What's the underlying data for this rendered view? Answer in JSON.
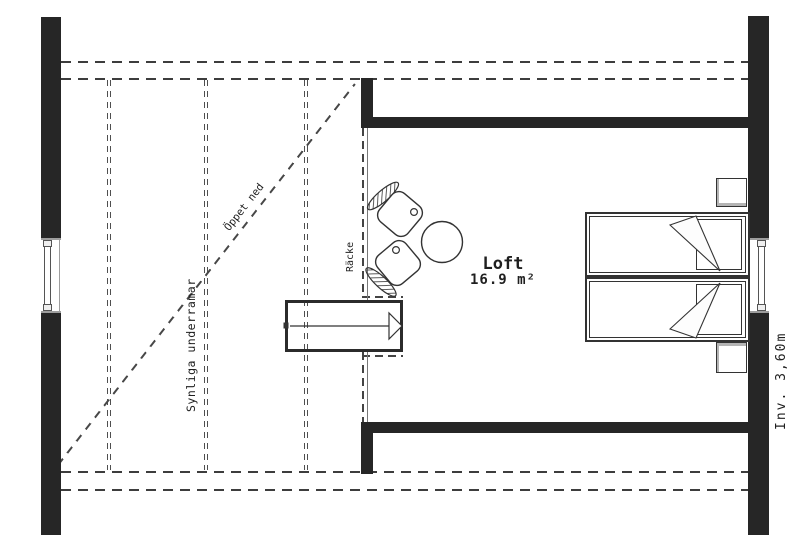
{
  "room": {
    "name": "Loft",
    "area": "16.9 m²"
  },
  "annotations": {
    "open_below": "Öppet ned",
    "visible_underframes": "Synliga underramar",
    "railing": "Räcke",
    "interior_dimension": "Inv. 3,60m"
  },
  "colors": {
    "background": "#ffffff",
    "wall": "#262626",
    "line": "#333333",
    "dash": "#454545",
    "light_gray": "#9e9e9e"
  }
}
